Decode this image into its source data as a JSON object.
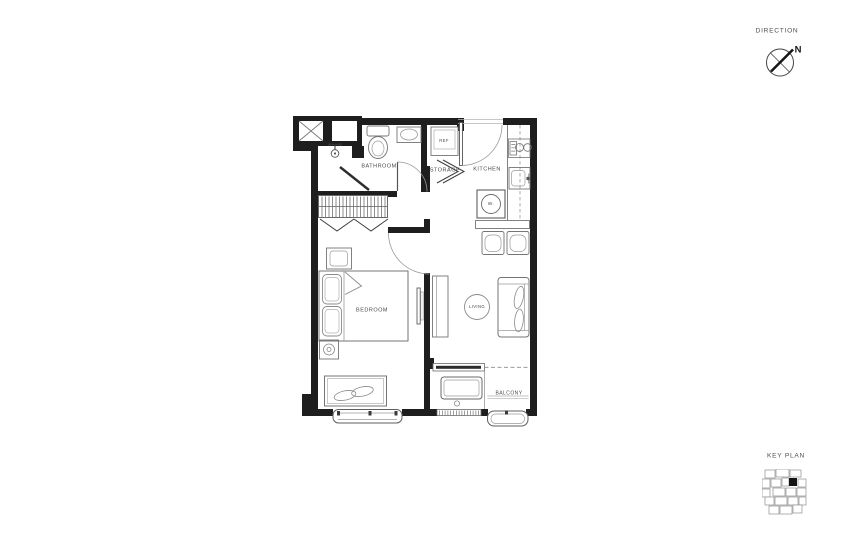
{
  "canvas": {
    "width": 845,
    "height": 540,
    "background": "#ffffff"
  },
  "direction": {
    "title": "DIRECTION",
    "north": "N"
  },
  "key_plan": {
    "title": "KEY PLAN"
  },
  "rooms": {
    "bathroom": "BATHROOM",
    "storage": "STORAGE",
    "kitchen": "KITCHEN",
    "refrigerator": "REF",
    "washer": "W.",
    "bedroom": "BEDROOM",
    "living": "LIVING",
    "balcony": "BALCONY"
  },
  "colors": {
    "wall": "#1e1e1e",
    "furniture_line": "#757575",
    "light_line": "#9a9a9a",
    "label_text": "#4a4a4a"
  }
}
